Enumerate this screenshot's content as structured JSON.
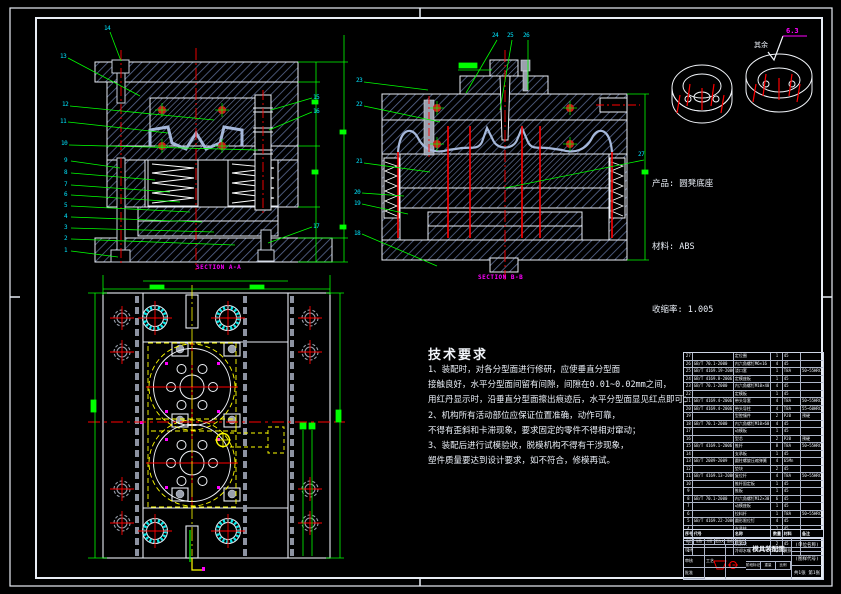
{
  "product_info": {
    "line1": "产品: 圆凳底座",
    "line2": "材料: ABS",
    "line3": "收缩率: 1.005"
  },
  "surface_note": {
    "rest_label": "其余",
    "roughness_value": "6.3"
  },
  "section_labels": {
    "left_view": "SECTION A-A",
    "middle_view": "SECTION B-B"
  },
  "tech_requirements": {
    "title": "技术要求",
    "lines": [
      "1、装配时，对各分型面进行修研，应使垂直分型面",
      "接触良好，水平分型面间留有间隙，间隙在0.01~0.02mm之间，",
      "用红丹显示时，沿垂直分型面擦出痕迹后，水平分型面显见红点即可：",
      "2、机构所有活动部位应保证位置准确，动作可靠，",
      "不得有歪斜和卡滞现象，要求固定的零件不得相对窜动；",
      "3、装配后进行试模验收，脱模机构不得有干涉现象，",
      "塑件质量要达到设计要求，如不符合，修模再试。"
    ]
  },
  "balloons": [
    "14",
    "13",
    "12",
    "11",
    "10",
    "9",
    "8",
    "7",
    "6",
    "5",
    "4",
    "3",
    "2",
    "1",
    "15",
    "16",
    "17",
    "23",
    "22",
    "21",
    "20",
    "19",
    "18",
    "24",
    "25",
    "26",
    "27"
  ],
  "bom": {
    "headers": [
      "序号",
      "代号",
      "名称",
      "数量",
      "材料",
      "备注"
    ],
    "rows": [
      [
        "27",
        "",
        "定位圈",
        "1",
        "45",
        ""
      ],
      [
        "26",
        "GB/T 70.1-2000",
        "内六角螺钉M6×16",
        "4",
        "45",
        ""
      ],
      [
        "25",
        "GB/T 4169.19-2006",
        "浇口套",
        "1",
        "T8A",
        "50~55HRC"
      ],
      [
        "24",
        "GB/T 4169.8-2006",
        "定模座板",
        "1",
        "45",
        ""
      ],
      [
        "23",
        "GB/T 70.1-2000",
        "内六角螺钉M10×40",
        "4",
        "45",
        ""
      ],
      [
        "22",
        "",
        "定模板",
        "1",
        "45",
        ""
      ],
      [
        "21",
        "GB/T 4169.4-2006",
        "带头导套",
        "4",
        "T8A",
        "50~55HRC"
      ],
      [
        "20",
        "GB/T 4169.4-2006",
        "带头导柱",
        "4",
        "T8A",
        "55~60HRC"
      ],
      [
        "19",
        "",
        "型腔镶件",
        "2",
        "P20",
        "预硬"
      ],
      [
        "18",
        "GB/T 70.1-2000",
        "内六角螺钉M10×60",
        "4",
        "45",
        ""
      ],
      [
        "17",
        "",
        "动模板",
        "1",
        "45",
        ""
      ],
      [
        "16",
        "",
        "型芯",
        "2",
        "P20",
        "预硬"
      ],
      [
        "15",
        "GB/T 4169.1-2006",
        "推杆",
        "8",
        "T8A",
        "50~55HRC"
      ],
      [
        "14",
        "",
        "支承板",
        "1",
        "45",
        ""
      ],
      [
        "13",
        "GB/T 2089-2009",
        "圆柱螺旋压缩弹簧",
        "4",
        "65Mn",
        ""
      ],
      [
        "12",
        "",
        "垫块",
        "2",
        "45",
        ""
      ],
      [
        "11",
        "GB/T 4169.13-2006",
        "复位杆",
        "4",
        "T8A",
        "50~55HRC"
      ],
      [
        "10",
        "",
        "推杆固定板",
        "1",
        "45",
        ""
      ],
      [
        "9",
        "",
        "推板",
        "1",
        "45",
        ""
      ],
      [
        "8",
        "GB/T 70.1-2000",
        "内六角螺钉M12×30",
        "6",
        "45",
        ""
      ],
      [
        "7",
        "",
        "动模座板",
        "1",
        "45",
        ""
      ],
      [
        "6",
        "",
        "拉料杆",
        "1",
        "T8A",
        "50~55HRC"
      ],
      [
        "5",
        "GB/T 4169.22-2006",
        "圆形限位钉",
        "4",
        "45",
        ""
      ],
      [
        "4",
        "",
        "支承柱",
        "2",
        "45",
        ""
      ],
      [
        "3",
        "GB/T 70.1-2000",
        "内六角螺钉M8×20",
        "4",
        "45",
        ""
      ],
      [
        "2",
        "",
        "楔紧块",
        "2",
        "45",
        ""
      ],
      [
        "1",
        "",
        "冷却水嘴",
        "4",
        "黄铜",
        ""
      ]
    ]
  },
  "title_block": {
    "name": "模具装配图",
    "org": "(单位名称)",
    "code": "(图样代号)",
    "sheet": "共1张 第1张",
    "labels": {
      "mark": "标记",
      "count": "处数",
      "zone": "分区",
      "doc": "更改文件号",
      "sign": "签名",
      "date": "年月日",
      "design": "设计",
      "check": "审核",
      "process": "工艺",
      "approve": "批准",
      "stage": "阶段标记",
      "weight": "重量",
      "scale": "比例"
    }
  },
  "colors": {
    "background": "#000000",
    "outline": "#e8edf5",
    "hatch": "#5a6a92",
    "part": "#a6b8da",
    "centerline": "#ff0000",
    "balloon": "#00e5ff",
    "dimension": "#00ff00",
    "section_label": "#ff00ff",
    "runner": "#ffff00",
    "bushing": "#00e5e5"
  }
}
